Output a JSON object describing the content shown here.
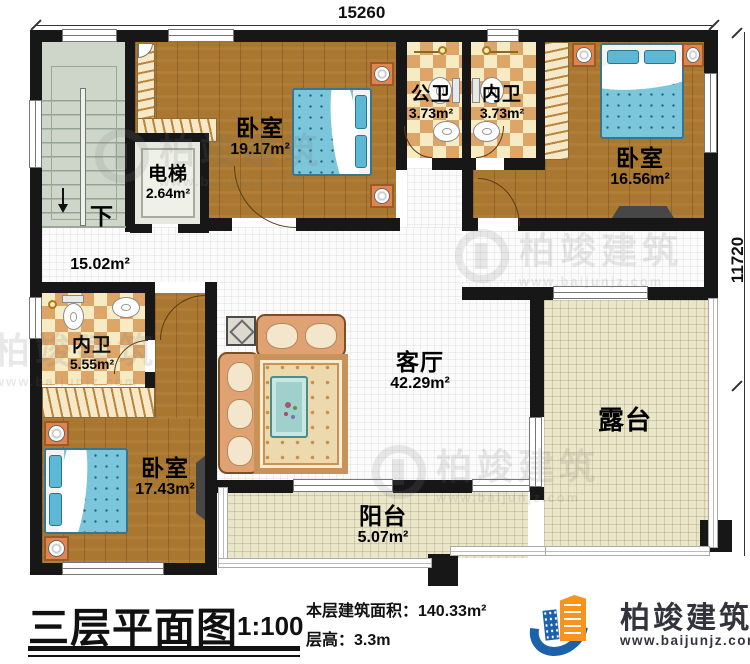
{
  "dimensions": {
    "top": "15260",
    "right": "11720"
  },
  "rooms": {
    "bedroom_top": {
      "name": "卧室",
      "area": "19.17m²"
    },
    "public_bath": {
      "name": "公卫",
      "area": "3.73m²"
    },
    "inner_bath_top": {
      "name": "内卫",
      "area": "3.73m²"
    },
    "bedroom_right": {
      "name": "卧室",
      "area": "16.56m²"
    },
    "elevator": {
      "name": "电梯",
      "area": "2.64m²"
    },
    "stairs": {
      "down_label": "下"
    },
    "hallway": {
      "area": "15.02m²"
    },
    "inner_bath_left": {
      "name": "内卫",
      "area": "5.55m²"
    },
    "bedroom_bottom": {
      "name": "卧室",
      "area": "17.43m²"
    },
    "living_room": {
      "name": "客厅",
      "area": "42.29m²"
    },
    "terrace": {
      "name": "露台"
    },
    "balcony": {
      "name": "阳台",
      "area": "5.07m²"
    }
  },
  "title_block": {
    "title": "三层平面图",
    "scale": "1:100",
    "area_line": "本层建筑面积：140.33m²",
    "floor_height_line": "层高：3.3m"
  },
  "brand": {
    "name": "柏竣建筑",
    "website": "www.baijunjz.com",
    "blue": "#1b62ab",
    "orange": "#f7941d"
  },
  "palette": {
    "wall": "#171717",
    "wood_floor": "#a9772f",
    "tile_light": "#f7ebc4",
    "tile_dark": "#dda668",
    "terrace_floor": "#eae6c9",
    "stairs_floor": "#cdd6c9",
    "bed_blue": "#7cc6db"
  }
}
